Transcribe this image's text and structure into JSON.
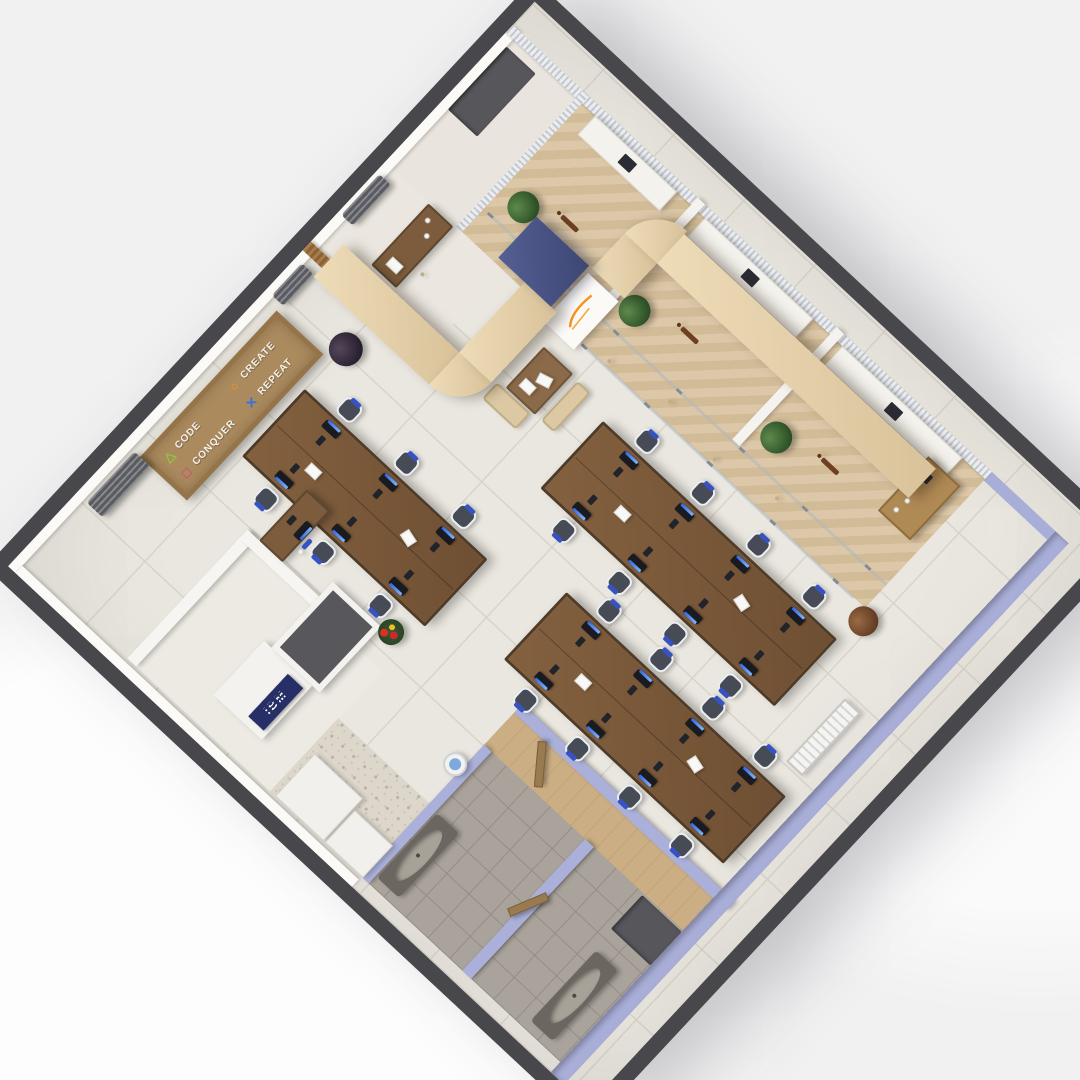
{
  "scene": {
    "type": "3d-isometric-office-floor-plan-render",
    "background": "#f1f1f2",
    "rotation_deg": -47
  },
  "palette": {
    "outer_wall": "#47474c",
    "inner_wall": "#f6f5f1",
    "lavender_wall": "#a9aed8",
    "floor_tile": "#eae7e0",
    "herringbone_wood": "#d7c3a2",
    "canopy_wood": "#e0cba6",
    "desk_wood": "#7a5a3d",
    "navy_pillar": "#4a5480",
    "screen_blue": "#2e66e8",
    "chair_headrest_blue": "#3753c2",
    "leather_chair": "#8a532f",
    "washroom_tile": "#a9a39b",
    "accent_orange": "#f7941d"
  },
  "signboard": {
    "items": [
      {
        "icon": "triangle-icon",
        "glyph": "△",
        "color": "#8dc63f",
        "label": "CODE"
      },
      {
        "icon": "square-icon",
        "glyph": "□",
        "color": "#ec268f",
        "label": "CONQUER"
      },
      {
        "icon": "circle-icon",
        "glyph": "○",
        "color": "#f7941d",
        "label": "CREATE"
      },
      {
        "icon": "x-icon",
        "glyph": "✕",
        "color": "#3a6fe0",
        "label": "REPEAT"
      }
    ]
  },
  "reception": {
    "brand": "IBM"
  },
  "floorplan": {
    "room": {
      "width": 740,
      "height": 760
    },
    "items": [
      {
        "type": "ac-unit",
        "x": 100,
        "y": 14,
        "w": 70,
        "h": 22
      },
      {
        "type": "ac-unit",
        "x": 378,
        "y": 8,
        "w": 44,
        "h": 16
      },
      {
        "type": "ac-unit",
        "x": 484,
        "y": 4,
        "w": 56,
        "h": 16
      },
      {
        "type": "desk-cluster",
        "x": 240,
        "y": 96,
        "w": 92,
        "h": 250,
        "seats": 3
      },
      {
        "type": "desk-cluster",
        "x": 420,
        "y": 336,
        "w": 92,
        "h": 320,
        "seats": 4
      },
      {
        "type": "desk-cluster",
        "x": 270,
        "y": 426,
        "w": 92,
        "h": 300,
        "seats": 4
      },
      {
        "type": "small-desk",
        "x": 190,
        "y": 166,
        "w": 70,
        "h": 32
      },
      {
        "type": "chair-white",
        "x": 208,
        "y": 202
      },
      {
        "type": "wood-desk",
        "x": 468,
        "y": 60,
        "w": 84,
        "h": 34
      },
      {
        "type": "stool",
        "x": 494,
        "y": 102
      },
      {
        "type": "white-desk",
        "x": 704,
        "y": 122,
        "w": 26,
        "h": 112
      },
      {
        "type": "white-desk",
        "x": 704,
        "y": 272,
        "w": 26,
        "h": 148
      },
      {
        "type": "white-desk",
        "x": 704,
        "y": 460,
        "w": 26,
        "h": 164
      },
      {
        "type": "chair-leather",
        "x": 632,
        "y": 160
      },
      {
        "type": "chair-leather",
        "x": 632,
        "y": 324
      },
      {
        "type": "chair-leather",
        "x": 632,
        "y": 516
      },
      {
        "type": "wood-cabinet",
        "x": 634,
        "y": 598,
        "w": 74,
        "h": 44
      },
      {
        "type": "plant",
        "x": 598,
        "y": 116,
        "r": 16
      },
      {
        "type": "plant",
        "x": 598,
        "y": 268,
        "r": 16
      },
      {
        "type": "plant",
        "x": 602,
        "y": 458,
        "r": 16
      },
      {
        "type": "plant-dark",
        "x": 372,
        "y": 82,
        "r": 17
      },
      {
        "type": "plant-dried",
        "x": 528,
        "y": 648,
        "r": 15
      },
      {
        "type": "plant-red",
        "x": 200,
        "y": 312,
        "r": 13
      },
      {
        "type": "stool",
        "x": 558,
        "y": 298
      },
      {
        "type": "stool",
        "x": 570,
        "y": 370
      },
      {
        "type": "stool",
        "x": 558,
        "y": 442
      },
      {
        "type": "stool",
        "x": 572,
        "y": 514
      },
      {
        "type": "bench",
        "x": 446,
        "y": 232,
        "w": 22,
        "h": 46
      },
      {
        "type": "bench",
        "x": 470,
        "y": 290,
        "w": 54,
        "h": 18
      },
      {
        "type": "paper-table",
        "x": 470,
        "y": 242,
        "w": 56,
        "h": 40
      },
      {
        "type": "radiator",
        "x": 388,
        "y": 702,
        "w": 86,
        "h": 22
      },
      {
        "type": "water-cooler",
        "x": 148,
        "y": 450,
        "r": 12
      },
      {
        "type": "sink",
        "x": 24,
        "y": 482,
        "w": 88,
        "h": 30
      },
      {
        "type": "sink",
        "x": 24,
        "y": 692,
        "w": 96,
        "h": 30
      },
      {
        "type": "dark-mat",
        "x": 146,
        "y": 688,
        "w": 46,
        "h": 54
      },
      {
        "type": "dark-mat",
        "x": 634,
        "y": 10,
        "w": 86,
        "h": 40
      },
      {
        "type": "door-leaf",
        "x": 200,
        "y": 534,
        "w": 46,
        "h": 9,
        "rot": -38
      },
      {
        "type": "door-leaf",
        "x": 88,
        "y": 598,
        "w": 42,
        "h": 9,
        "rot": 24
      },
      {
        "type": "glass-partition",
        "x": 552,
        "y": 268,
        "w": 3,
        "h": 372
      },
      {
        "type": "glass-partition",
        "x": 584,
        "y": 110,
        "w": 3,
        "h": 545
      }
    ]
  }
}
